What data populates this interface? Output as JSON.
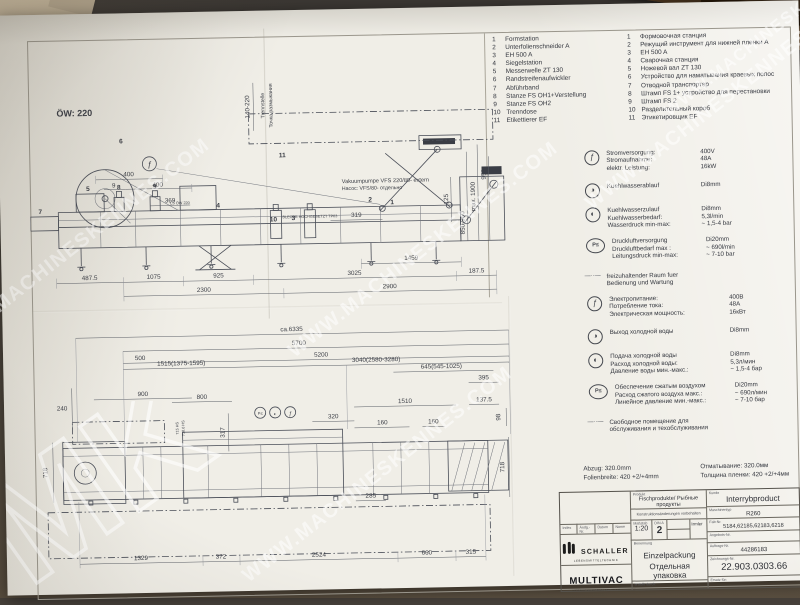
{
  "watermark": {
    "text": "WWW.MACHINESKENNES.COM",
    "initials": "MK"
  },
  "icons": {
    "power": "ƒ",
    "water_out": "◑",
    "water_in": "◐",
    "air": "P≤",
    "dash": "—··—"
  },
  "legend": {
    "items": [
      {
        "num": "1",
        "de": "Formstation",
        "ru": "Формовочная станция"
      },
      {
        "num": "2",
        "de": "Unterfolienschneider A",
        "ru": "Режущий инструмент для нижней пленки A"
      },
      {
        "num": "3",
        "de": "EH 500 A",
        "ru": "EH 500 A"
      },
      {
        "num": "4",
        "de": "Siegelstation",
        "ru": "Сварочная станция"
      },
      {
        "num": "5",
        "de": "Messerwelle ZT 130",
        "ru": "Ножевой вал ZT 130"
      },
      {
        "num": "6",
        "de": "Randstreifenaufwickler",
        "ru": "Устройство для наматывания краевых полос"
      },
      {
        "num": "7",
        "de": "Abführband",
        "ru": "Отводной транспортер"
      },
      {
        "num": "8",
        "de": "Stanze FS OH1+Verstellung",
        "ru": "Штамп FS 1+ устройство для перестановки"
      },
      {
        "num": "9",
        "de": "Stanze FS OH2",
        "ru": "Штамп FS 2"
      },
      {
        "num": "10",
        "de": "Trenndose",
        "ru": "Разделительный короб"
      },
      {
        "num": "11",
        "de": "Etikettierer EF",
        "ru": "Этикетировщик EF"
      }
    ]
  },
  "specs_de": {
    "power_rows": [
      [
        "Stromversorgung:",
        "400V"
      ],
      [
        "Stromaufnahme:",
        "48A"
      ],
      [
        "elektr. Leistung:",
        "16kW"
      ]
    ],
    "wout_rows": [
      [
        "Kuehlwasserablauf",
        "Di8mm"
      ]
    ],
    "win_rows": [
      [
        "Kuehlwasserzulauf",
        "Di8mm"
      ],
      [
        "Kuehlwasserbedarf:",
        "5,3l/min"
      ],
      [
        "Wasserdruck min-max:",
        "~ 1,5-4 bar"
      ]
    ],
    "air_rows": [
      [
        "Druckluftversorgung",
        "Di20mm"
      ],
      [
        "Druckluftbedarf max :",
        "~ 690l/min"
      ],
      [
        "Leitungsdruck min-max:",
        "~ 7-10 bar"
      ]
    ],
    "free1": "freizuhaltender Raum fuer",
    "free2": "Bedienung und Wartung"
  },
  "specs_ru": {
    "power_rows": [
      [
        "Электропитание:",
        "400В"
      ],
      [
        "Потребление тока:",
        "48А"
      ],
      [
        "Электрическая мощность:",
        "16кВт"
      ]
    ],
    "wout_rows": [
      [
        "Выход холодной воды",
        "Di8mm"
      ]
    ],
    "win_rows": [
      [
        "Подача холодной воды",
        "Di8mm"
      ],
      [
        "Расход холодной воды:",
        "5,3л/мин"
      ],
      [
        "Давление воды мин.-макс.:",
        "~ 1,5-4 бар"
      ]
    ],
    "air_rows": [
      [
        "Обеспечение сжатым воздухом",
        "Di20mm"
      ],
      [
        "Расход сжатого воздуха макс.:",
        "~ 690л/мин"
      ],
      [
        "Линейное давление мин.-макс.:",
        "~ 7-10 бар"
      ]
    ],
    "free1": "Свободное помещение для",
    "free2": "обслуживания и техобслуживания"
  },
  "side": {
    "ow": "ÖW: 220",
    "pump_de": "Vakuumpumpe VFS 220/80- extern",
    "pump_ru": "Насос: VFS/80- отдельно",
    "note1": "LS ÖW 220",
    "note2": "BLECHE HOCHGESETZT TP03",
    "sep_de": "Trennstelle",
    "sep_ru": "Точка размыкания",
    "d400a": "400",
    "d9": "9",
    "d400b": "400",
    "d369": "369",
    "d319": "319",
    "d4875": "487.5",
    "d1075": "1075",
    "d925": "925",
    "d3025": "3025",
    "d1875": "187.5",
    "d1459": "1459",
    "d2300": "2300",
    "d2900": "2900",
    "v140": "140-220",
    "v950": "950",
    "v1900": "max. 1900",
    "v125": "125",
    "v850": "850-950",
    "c1": "1",
    "c2": "2",
    "c3": "3",
    "c4": "4",
    "c5": "5",
    "c6": "6",
    "c7": "7",
    "c8": "8",
    "c9": "9",
    "c10": "10",
    "c11": "11",
    "cf": "ƒ"
  },
  "top": {
    "d6335": "ca.6335",
    "d5700": "5700",
    "d5200": "5200",
    "d500": "500",
    "d1515": "1515(1375-1595)",
    "d3040": "3040(2580-3280)",
    "d645": "645(545-1025)",
    "d900": "900",
    "d800": "800",
    "d240": "240",
    "d317": "317",
    "d395": "395",
    "d1510": "1510",
    "d1375": "137.5",
    "d98": "98",
    "d160a": "160",
    "d160b": "160",
    "d320": "320",
    "d718l": "718",
    "d718r": "718",
    "d285": "285",
    "d1329": "1329",
    "d372": "372",
    "d2524": "2524",
    "d660": "660",
    "d315": "315",
    "hs1": "715 HS",
    "hs2": "718.6 HS",
    "f_de1": "Abzug: 320.0mm",
    "f_de2": "Folienbreite: 420 +2/+4mm",
    "f_ru1": "Отматывание: 320.0мм",
    "f_ru2": "Толщина пленки: 420 +2/+4мм"
  },
  "tb": {
    "produkt_label": "Produkt",
    "produkt": "Fischprodukte/ Рыбные продукты",
    "kunde_label": "Kunde",
    "kunde": "Interrybproduct",
    "note": "Konstruktionsänderungen vorbehalten",
    "mtyp_label": "Maschinentyp",
    "mtyp": "R260",
    "fab_label": "Fab-Nr.",
    "fab": "5184,62185,62183,6218",
    "angebot_label": "Angebots-Nr.",
    "masstab_label": "Maßstab",
    "masstab": "1:20",
    "din_label": "DIN A",
    "din": "2",
    "gez_label": "gez.",
    "gez_date": "27.03.03",
    "gepr_label": "gepr.",
    "pname": "Irmler",
    "index_label": "Index",
    "aendg_label": "Ändg.-Nr.",
    "datum_label": "Datum",
    "name_label": "Name",
    "schaller": "SCHALLER",
    "schaller_sub": "LEBENSMITTELTECHNIK",
    "multivac": "MULTIVAC",
    "multivac_sub": "VERPACKUNGSMASCHINEN",
    "benennung_label": "Benennung",
    "ben_de": "Einzelpackung",
    "ben_ru": "Отдельная упаковка",
    "auftrag_label": "Auftrags-Nr.",
    "auftrag": "44286183",
    "zeich_label": "Zeichnungs-Nr.",
    "zeich": "22.903.0303.66",
    "erstellt_label": "erstellt durch:",
    "ersatz_label": "Ersatz für:"
  }
}
